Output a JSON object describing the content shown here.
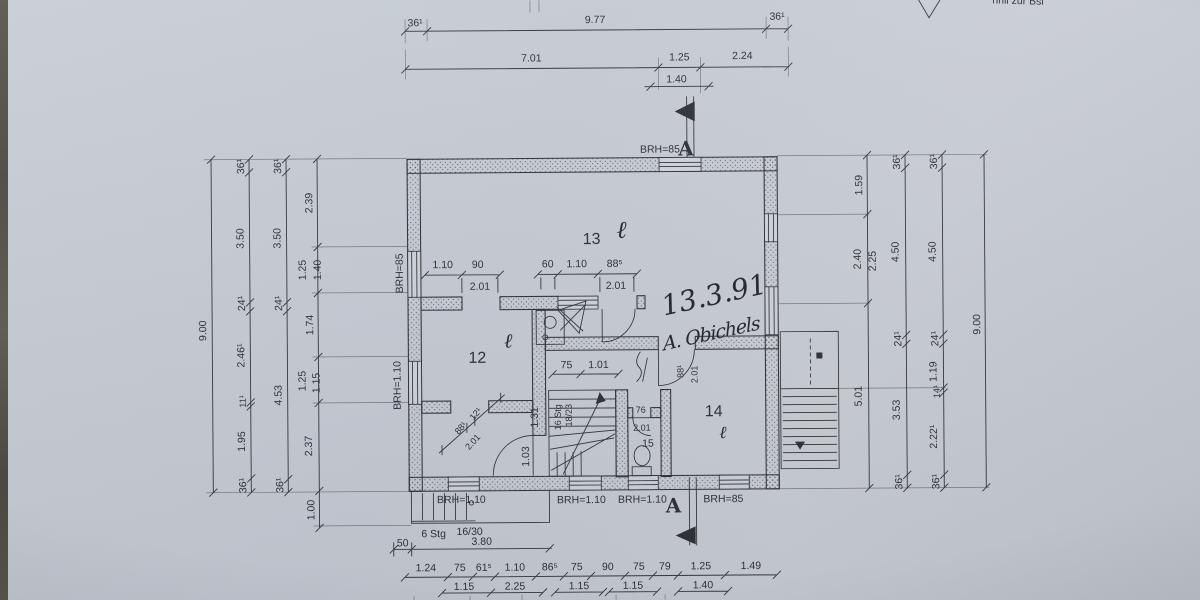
{
  "colors": {
    "paper": "#c7ccd4",
    "ink": "#2f3237",
    "carpet": "#57554e"
  },
  "stamp": {
    "partial_text": "hnll zur Bsl"
  },
  "handwritten": {
    "date": "13.3.91",
    "signature": "A. Obichels",
    "loop": "ℓ"
  },
  "rooms": {
    "r12": "12",
    "r13": "13",
    "r14": "14",
    "r15": "15"
  },
  "section": {
    "top": "A",
    "bottom": "A"
  },
  "brh": {
    "top": "BRH=85",
    "left_upper": "BRH=85",
    "left_lower": "BRH=1.10",
    "bottom": [
      "BRH=1.10",
      "BRH=1.10",
      "BRH=1.10",
      "BRH=85"
    ]
  },
  "stairs": {
    "main": [
      "16 Stg",
      "18/23"
    ],
    "ext": [
      "6 Stg",
      "16/30"
    ]
  },
  "dims": {
    "top_row1": [
      "36¹",
      "9.77",
      "36¹"
    ],
    "top_row2": [
      "7.01",
      "1.25",
      "2.24",
      "1.40"
    ],
    "left_c1": [
      "9.00"
    ],
    "left_c2": [
      "36¹",
      "3.50",
      "24¹",
      "2.46¹",
      "11¹",
      "1.95",
      "36¹"
    ],
    "left_c3": [
      "36¹",
      "3.50",
      "24¹",
      "4.53",
      "36¹"
    ],
    "left_c4": [
      "2.39",
      "1.25",
      "1.40",
      "1.74",
      "1.25",
      "1.15",
      "2.37",
      "1.00"
    ],
    "right_c1": [
      "1.59",
      "2.40",
      "2.25",
      "5.01"
    ],
    "right_c2": [
      "36¹",
      "4.50",
      "24¹",
      "3.53",
      "36¹"
    ],
    "right_c3": [
      "36¹",
      "4.50",
      "24¹",
      "1.19",
      "14¹",
      "2.22¹",
      "36¹"
    ],
    "right_c4": [
      "9.00"
    ],
    "int_g1": [
      "1.10",
      "90",
      "2.01"
    ],
    "int_g2": [
      "60",
      "1.10",
      "88⁵",
      "2.01"
    ],
    "int_stair": [
      "75",
      "1.01",
      "1.31"
    ],
    "int_diag": [
      "88¹",
      "12¹",
      "2.01"
    ],
    "int_door_bl": [
      "1.03"
    ],
    "int_wc": [
      "76",
      "2.01"
    ],
    "int_door14": [
      "88¹",
      "2.01"
    ],
    "ext_stair": [
      "50",
      "3.80"
    ],
    "bottom_row1": [
      "1.24",
      "75",
      "61⁵",
      "1.10",
      "86⁵",
      "75",
      "90",
      "75",
      "79",
      "1.25",
      "1.49"
    ],
    "bottom_row2": [
      "1.15",
      "2.25",
      "1.15",
      "1.15",
      "1.40"
    ]
  }
}
